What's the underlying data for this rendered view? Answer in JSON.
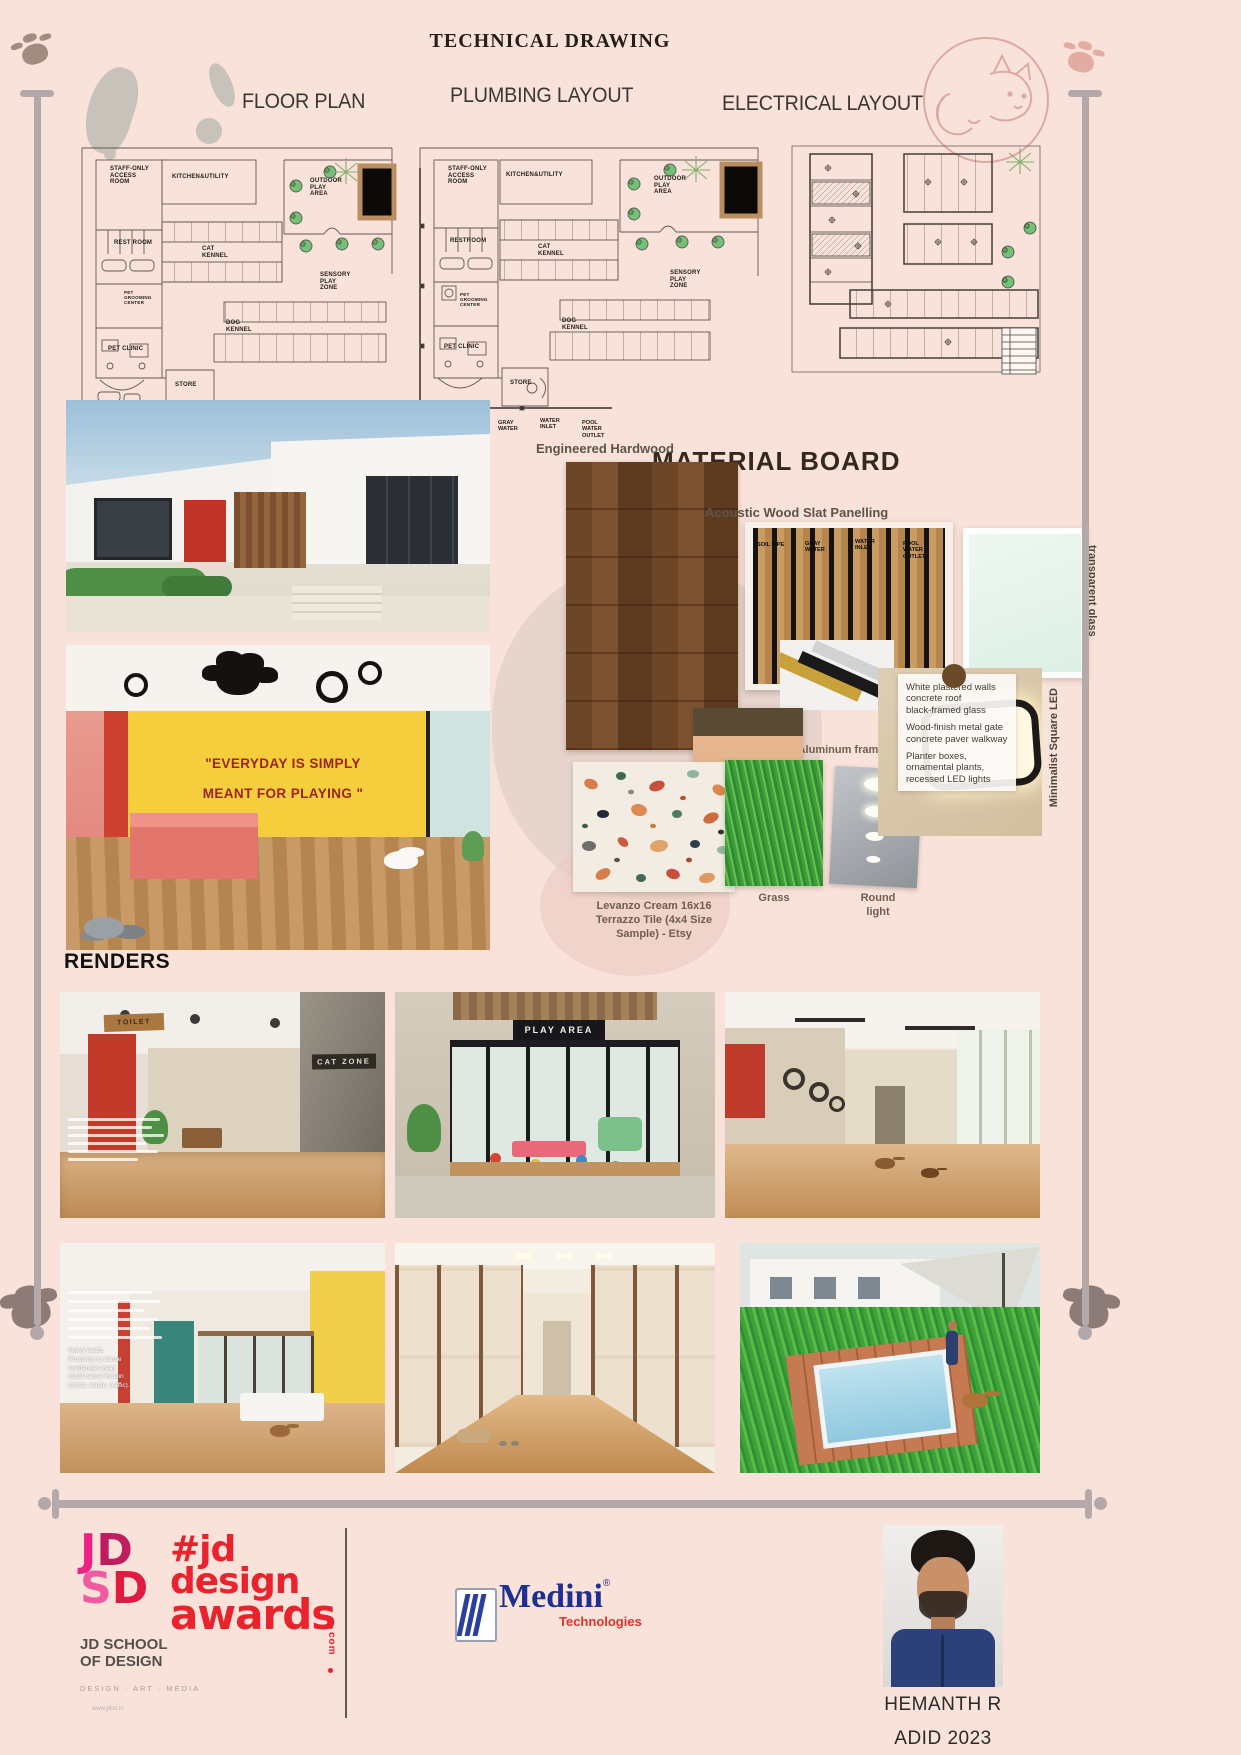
{
  "title": "TECHNICAL DRAWING",
  "colors": {
    "background": "#f9e2da",
    "jd_pink": "#ec2384",
    "awards_red": "#e8232e",
    "medini_blue": "#1d2f91",
    "medini_red": "#d7362b",
    "pool_frame": "#bb8e60"
  },
  "plans": {
    "floor": {
      "label": "FLOOR PLAN",
      "rooms": {
        "staff": "STAFF-ONLY\nACCESS\nROOM",
        "kitchen": "KITCHEN&UTILITY",
        "outdoor": "OUTDOOR\nPLAY\nAREA",
        "restroom": "REST ROOM",
        "cat_kennel": "CAT\nKENNEL",
        "grooming": "PET\nGROOMING\nCENTER",
        "sensory": "SENSORY\nPLAY\nZONE",
        "clinic": "PET CLINIC",
        "dog_kennel": "DOG\nKENNEL",
        "store": "STORE",
        "reception": "RECEPTION"
      }
    },
    "plumbing": {
      "label": "PLUMBING LAYOUT",
      "rooms": {
        "staff": "STAFF-ONLY\nACCESS\nROOM",
        "kitchen": "KITCHEN&UTILITY",
        "outdoor": "OUTDOOR\nPLAY\nAREA",
        "restroom": "RESTROOM",
        "cat_kennel": "CAT\nKENNEL",
        "grooming": "PET\nGROOMING\nCENTER",
        "sensory": "SENSORY\nPLAY\nZONE",
        "clinic": "PET CLINIC",
        "dog_kennel": "DOG\nKENNEL",
        "store": "STORE",
        "reception": "RECEPTION"
      },
      "legend": [
        "SOIL PIPE",
        "GRAY\nWATER",
        "WATER\nINLET",
        "POOL\nWATER\nOUTLET"
      ]
    },
    "electrical": {
      "label": "ELECTRICAL LAYOUT"
    }
  },
  "material_board": {
    "heading": "MATERIAL BOARD",
    "labels": {
      "hardwood": "Engineered Hardwood",
      "slat": "Acoustic Wood Slat Panelling",
      "glass": "transparent glass",
      "aluminum": "Aluminum frame",
      "color": "color",
      "terrazzo": "Levanzo Cream 16x16\nTerrazzo Tile (4x4 Size\nSample) - Etsy",
      "grass": "Grass",
      "round_light": "Round\nlight",
      "led": "Minimalist Square LED"
    },
    "slat_overlay": [
      "SOIL PIPE",
      "GRAY\nWATER",
      "WATER\nINLET",
      "POOL\nWATER\nOUTLET"
    ],
    "annotation": {
      "p1": "White plastered walls\nconcrete roof\nblack-framed glass",
      "p2": "Wood-finish metal gate\nconcrete paver walkway",
      "p3": "Planter boxes,\nornamental plants,\nrecessed LED lights"
    },
    "interior_quote_1": "\"EVERYDAY IS SIMPLY",
    "interior_quote_2": "MEANT FOR PLAYING \"",
    "palette_colors": [
      "#594a33",
      "#e4b58e",
      "#ece7d8",
      "#ffffff"
    ]
  },
  "renders": {
    "heading": "RENDERS",
    "signs": {
      "toilet": "TOILET",
      "cat_zone": "CAT ZONE",
      "play_area": "PLAY AREA"
    },
    "overlay2": "heavy loads.\nProximity to dense\nresidential areas\ncould cause friction\n(noise, waste, traffic)."
  },
  "footer": {
    "jd_letters": [
      "J",
      "D",
      "S",
      "D"
    ],
    "school_1": "JD SCHOOL",
    "school_2": "OF DESIGN",
    "school_tag": "DESIGN · ART · MEDIA",
    "school_url": "www.jdsd.in",
    "awards_1": "#jd",
    "awards_2": "design",
    "awards_3": "awards",
    "awards_com": "com",
    "medini": "Medini",
    "medini_r": "®",
    "medini_sub": "Technologies",
    "name": "HEMANTH R",
    "batch": "ADID 2023"
  }
}
